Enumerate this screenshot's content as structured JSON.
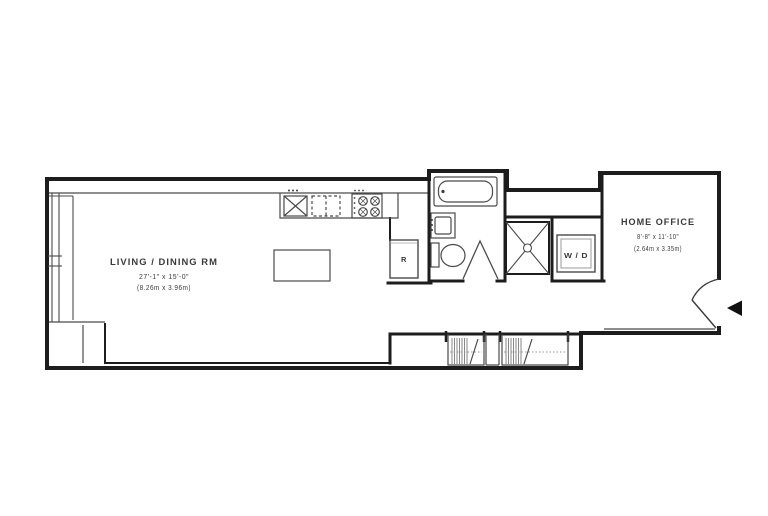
{
  "plan": {
    "rooms": [
      {
        "id": "living_dining",
        "name": "LIVING / DINING RM",
        "dims_imperial": "27'-1\" x 15'-0\"",
        "dims_metric": "(8.26m x 3.96m)"
      },
      {
        "id": "home_office",
        "name": "HOME OFFICE",
        "dims_imperial": "8'-8\" x 11'-10\"",
        "dims_metric": "(2.64m x 3.35m)"
      }
    ],
    "appliances": [
      {
        "id": "refrigerator",
        "label": "R"
      },
      {
        "id": "washer_dryer",
        "label": "W / D"
      }
    ],
    "icons": [
      {
        "name": "entry-arrow",
        "meaning": "unit entry direction"
      },
      {
        "name": "kitchen-sink",
        "meaning": "sink with X basin"
      },
      {
        "name": "stove",
        "meaning": "4-burner range"
      },
      {
        "name": "bathtub",
        "meaning": "bathtub"
      },
      {
        "name": "toilet",
        "meaning": "toilet"
      },
      {
        "name": "shower",
        "meaning": "shower stall with drain"
      },
      {
        "name": "closet-rod",
        "meaning": "closet hanging rod"
      }
    ],
    "colors": {
      "wall": "#1d1d1d",
      "thin_line": "#4a4a4a",
      "hatch": "#6a6a6a",
      "rod_dotted": "#9a9a9a",
      "arrow": "#111111",
      "background": "#ffffff"
    }
  }
}
